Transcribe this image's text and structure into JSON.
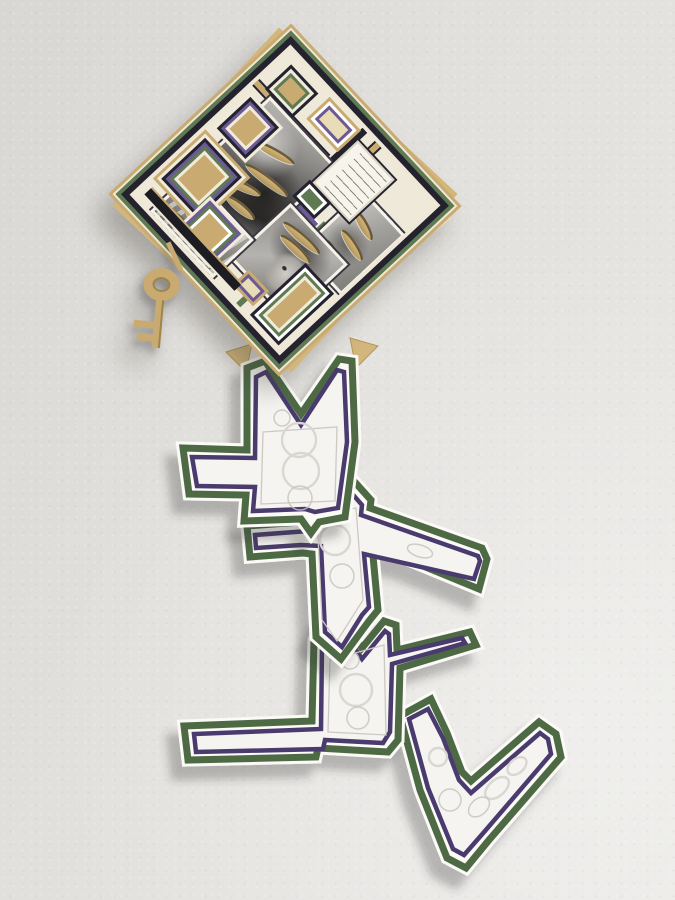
{
  "scene": {
    "description": "Photograph of a layered hand-cut paper collage artwork hanging on a textured off-white gallery wall",
    "wall_color": "#e2e0dc",
    "lighting": "soft light from upper right, shadows fall down-left"
  },
  "artwork": {
    "diamond_collage": {
      "shape": "diamond (rotated square panel)",
      "contents": "four black-and-white photographs of children with curved gold slits cut through, nested rectangular paper frames, small handwritten note (text illegible)",
      "border_layers": [
        "cream",
        "navy",
        "green",
        "cream",
        "gold tan backing"
      ]
    },
    "key_cutout": {
      "description": "gold paper skeleton key hanging from the left edge of the diamond",
      "color": "#c9ab72"
    },
    "paper_chain": {
      "segment_count": 4,
      "style": "white embossed paper shapes with green outer and purple inner outlines, cascading in a zigzag below the diamond",
      "embossing": "white-on-white swirl and knot reliefs"
    }
  },
  "colors": {
    "green": "#4e6b45",
    "green2": "#5f7a52",
    "purple": "#4a3a6e",
    "purple2": "#6b5a94",
    "navy": "#23222e",
    "gold": "#c9ab72",
    "goldD": "#a8893f",
    "tan": "#d2b67c",
    "cream": "#e9ddb8",
    "paper": "#fbfaf7",
    "paper2": "#f5f4f0",
    "wall": "#e2e0dc"
  }
}
